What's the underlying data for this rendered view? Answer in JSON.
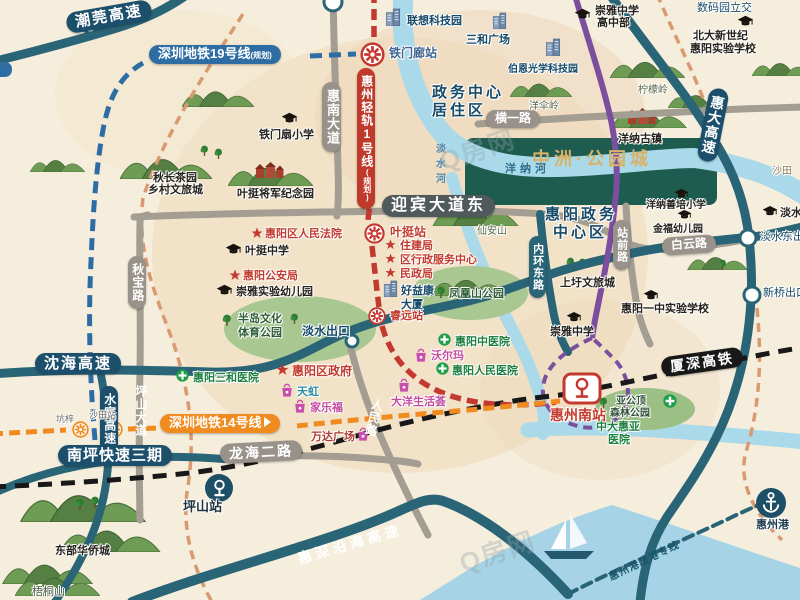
{
  "watermark": "Q房网",
  "project": {
    "name": "中洲·公园城"
  },
  "colors": {
    "highway_teal": "#2a6577",
    "label_navy": "#1b4f6b",
    "metro19_blue": "#2e6da4",
    "rail1_red": "#bf3a2b",
    "line14_orange": "#ef8b1f",
    "hsr_black": "#181818",
    "planned_purple": "#7b4f9e",
    "project_green": "#1d5c4e",
    "project_gold": "#d8b26a",
    "water_blue": "#a6d4e6"
  },
  "roads": {
    "chaowan": "潮莞高速",
    "shenhai": "沈海高速",
    "shuiguan": "水官高速",
    "huida": "惠大高速",
    "yanhai": "惠深沿海高速",
    "xiashen": "厦深高铁",
    "nanping": "南坪快速三期",
    "huinan": "惠南大道",
    "yingbin": "迎宾大道东",
    "hengyi": "横一路",
    "baiyun": "白云路",
    "qiubao": "秋宝路",
    "pingshan_dadao": "坪山大道",
    "longhai": "龙海二路",
    "renmin": "人民路",
    "neihuan": "内环东路",
    "zhanqian": "站前路",
    "shugang": "惠州港疏港专线"
  },
  "transit": {
    "line19": "深圳地铁19号线",
    "line19_tag": "(规划)",
    "line1": "惠州轻轨1号线",
    "line1_tag": "(规划)",
    "line14": "深圳地铁14号线"
  },
  "stations": {
    "tiemenlang": "铁门廊站",
    "yeting": "叶挺站",
    "ruiyuan": "睿远站",
    "kengzi": "坑梓",
    "shatian": "沙田站",
    "huizhounan": "惠州南站",
    "pingshan": "坪山站",
    "huizhougang": "惠州港"
  },
  "exits": {
    "danshui": "淡水出口",
    "danshui_east": "淡水东出口",
    "xinqiao": "新桥出口",
    "shuma": "数码园立交"
  },
  "areas": {
    "juzhuqu1": "政务中心",
    "juzhuqu2": "居住区",
    "zhengwu1": "惠阳政务",
    "zhengwu2": "中心区",
    "shangxu": "上圩文旅城",
    "guzhen": "洋纳古镇",
    "qiuchang1": "秋长茶园",
    "qiuchang2": "乡村文旅城",
    "jinianyuan": "叶挺将军纪念园",
    "dongbu": "东部华侨城"
  },
  "nature": {
    "yangsanling": "洋伞岭",
    "ningmengling": "柠檬岭",
    "xiananshan": "仙安山",
    "wutongshan": "梧桐山",
    "shatian_place": "沙田"
  },
  "water": {
    "danshuihe": "淡水河",
    "yangnahe": "洋纳河"
  },
  "parks": {
    "fenghuangshan": "凤凰山公园",
    "bandao1": "半岛文化",
    "bandao2": "体育公园",
    "yagongding1": "亚公顶",
    "yagongding2": "森林公园"
  },
  "schools": {
    "tiemenshan": "铁门扇小学",
    "yeting": "叶挺中学",
    "chongya_kid": "崇雅实验幼儿园",
    "chongya_high1": "崇雅中学",
    "chongya_high2": "高中部",
    "beida1": "北大新世纪",
    "beida2": "惠阳实验学校",
    "yangna": "洋纳善培小学",
    "jinfu": "金福幼儿园",
    "yizhong": "惠阳一中实验学校",
    "chongya": "崇雅中学",
    "danshui": "淡水小学"
  },
  "gov": {
    "fayuan": "惠阳区人民法院",
    "gonganju": "惠阳公安局",
    "zhujianju": "住建局",
    "fuwu": "区行政服务中心",
    "minzheng": "民政局",
    "quzhengfu": "惠阳区政府"
  },
  "hospitals": {
    "sanhe": "惠阳三和医院",
    "zhongyi": "惠阳中医院",
    "renmin": "惠阳人民医院",
    "zhongda1": "中大惠亚",
    "zhongda2": "医院"
  },
  "shops": {
    "tianhong": "天虹",
    "jialefu": "家乐福",
    "wanda": "万达广场",
    "woerma": "沃尔玛",
    "dayang": "大洋生活荟"
  },
  "buildings": {
    "lianxiang": "联想科技园",
    "sanhe_plaza": "三和广场",
    "boen": "伯恩光学科技园",
    "haoyikang1": "好益康",
    "haoyikang2": "大厦"
  }
}
